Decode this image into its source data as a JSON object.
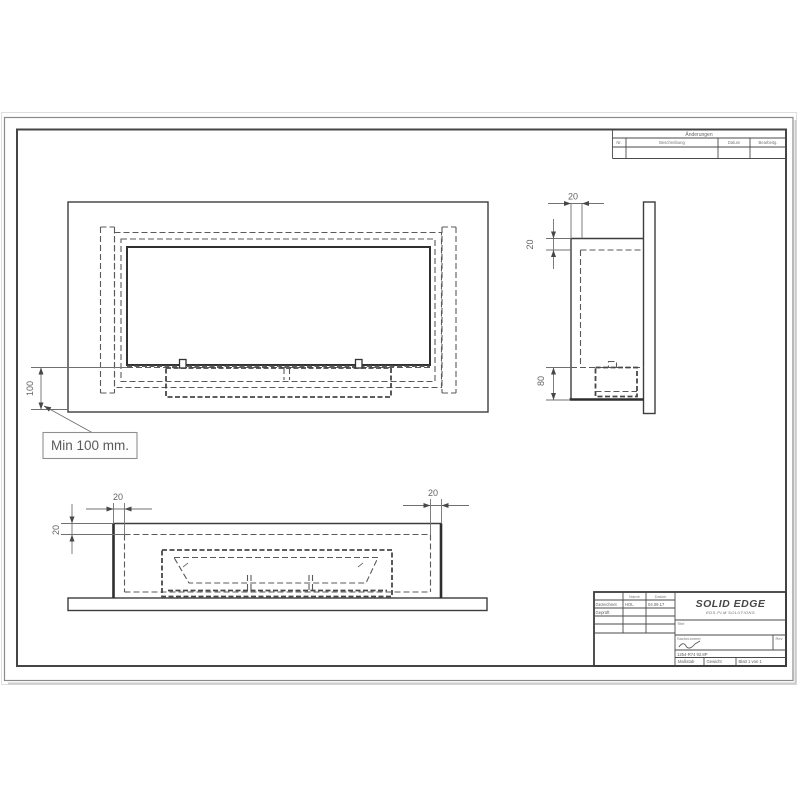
{
  "revision_table": {
    "title": "Änderungen",
    "col_nr": "Nr.",
    "col_desc": "Beschreibung",
    "col_date": "Datum",
    "col_edit": "Bearbeitg."
  },
  "title_block": {
    "col_name": "Name",
    "col_date": "Datum",
    "row_drawn": "Gezeichnet",
    "drawn_name": "HOL",
    "drawn_date": "04.09.17",
    "row_checked": "Geprüft",
    "logo": "SOLID EDGE",
    "logo_sub": "EDS-PLM SOLUTIONS",
    "title_label": "Titel",
    "partno_label": "Sachnummer",
    "rev_label": "Rev",
    "doc_number": "1254-R74 92.8P",
    "scale_label": "Maßstab",
    "weight_label": "Gewicht",
    "sheet_label": "Blatt 1 von 1"
  },
  "front_view": {
    "dim_height": "100",
    "note": "Min 100 mm."
  },
  "side_view": {
    "dim_depth": "20",
    "dim_wall": "20",
    "dim_burner": "80"
  },
  "bottom_view": {
    "dim_left": "20",
    "dim_right": "20",
    "dim_wall": "20"
  }
}
